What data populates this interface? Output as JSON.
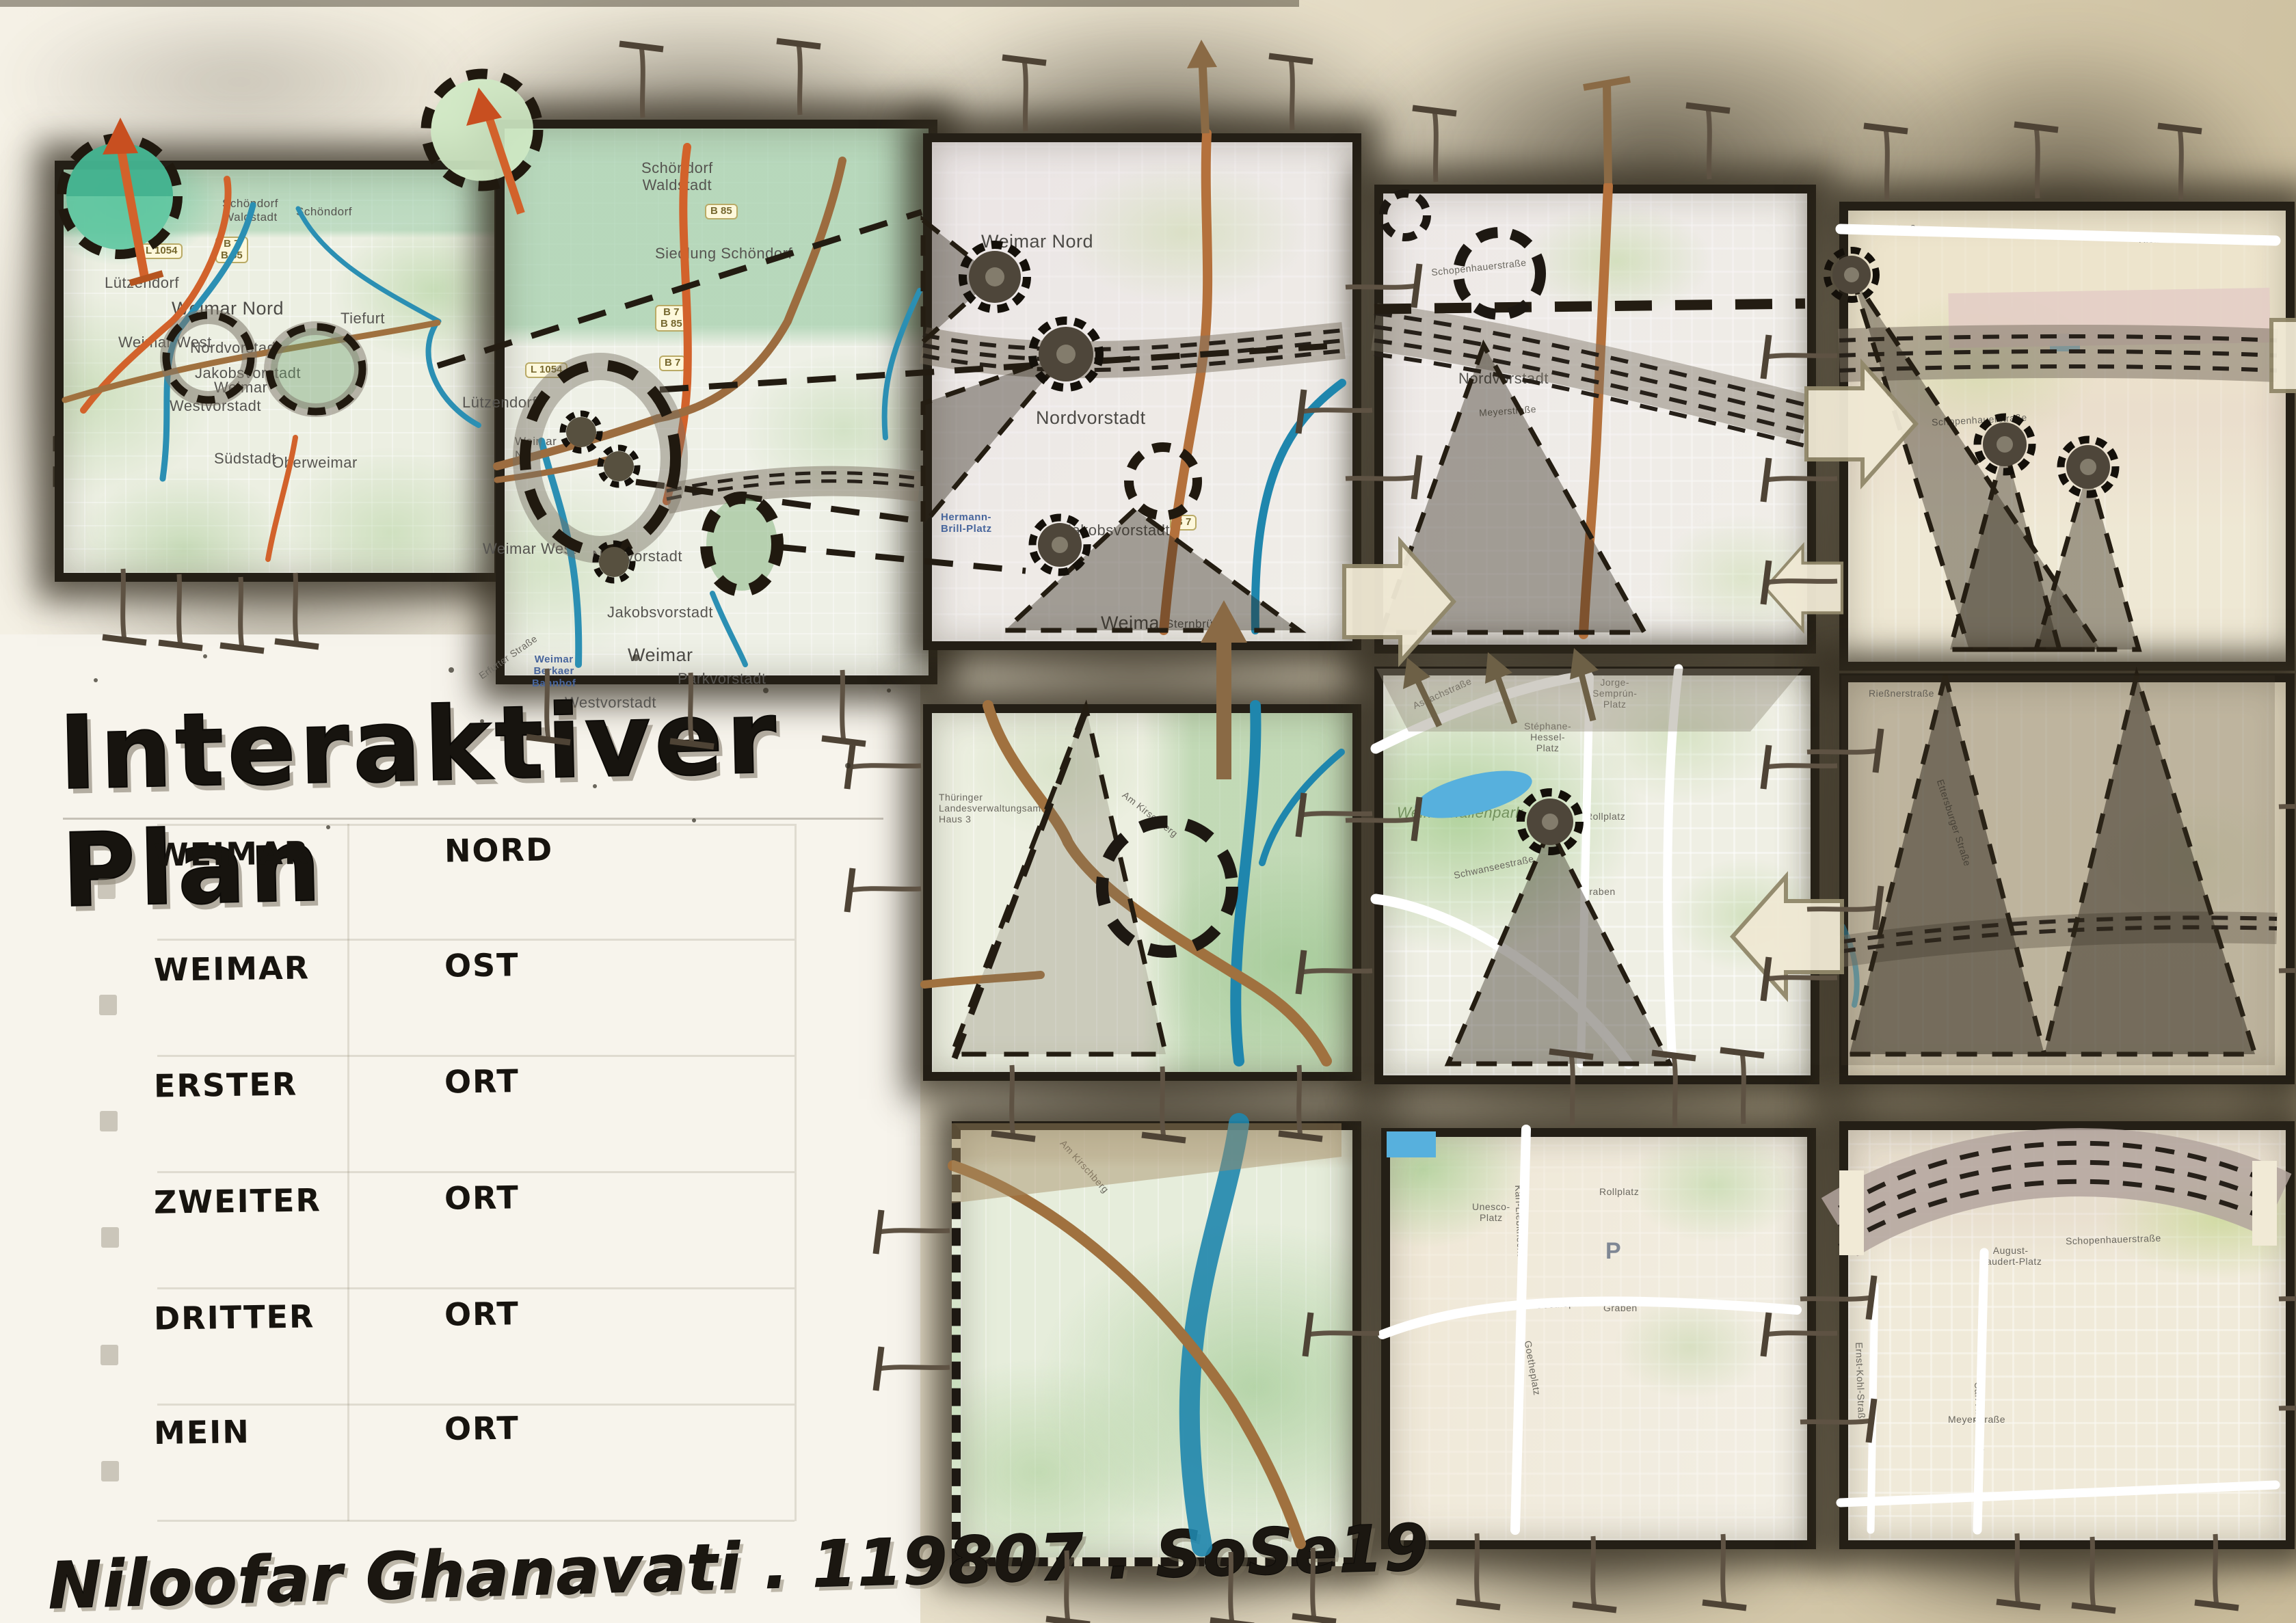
{
  "title": "Interaktiver Plan",
  "signature": "Niloofar Ghanavati . 119807 . SoSe19",
  "legend": {
    "rows": [
      {
        "w1": "WEIMAR",
        "w2": "NORD"
      },
      {
        "w1": "WEIMAR",
        "w2": "OST"
      },
      {
        "w1": "ERSTER",
        "w2": "ORT"
      },
      {
        "w1": "ZWEITER",
        "w2": "ORT"
      },
      {
        "w1": "DRITTER",
        "w2": "ORT"
      },
      {
        "w1": "MEIN",
        "w2": "ORT"
      }
    ]
  },
  "panels": {
    "p1": {
      "labels": [
        "Schöndorf\nWaldstadt",
        "Schöndorf",
        "Lützendorf",
        "Weimar Nord",
        "Tiefurt",
        "Weimar West",
        "Nordvorstadt",
        "Jakobsvorstadt",
        "Weimar",
        "Westvorstadt",
        "Südstadt",
        "Oberweimar"
      ],
      "badges": [
        "L 1054",
        "B 7\nB 85"
      ]
    },
    "p2": {
      "labels": [
        "Schöndorf\nWaldstadt",
        "Siedlung Schöndorf",
        "Lützendorf",
        "Weimar\nNord",
        "Weimar West",
        "Nordvorstadt",
        "Jakobsvorstadt",
        "Weimar",
        "Parkvorstadt",
        "Westvorstadt",
        "Weimar\nBerkaer\nBahnhof",
        "Erfurter Straße"
      ],
      "badges": [
        "B 85",
        "B 7\nB 85",
        "B 7",
        "L 1054"
      ]
    },
    "p3a": {
      "labels": [
        "Weimar Nord",
        "Nordvorstadt",
        "Jakobsvorstadt",
        "Weimar",
        "Sternbrücke",
        "Hermann-\nBrill-Platz"
      ],
      "badges": [
        "B 7"
      ]
    },
    "p3b": {
      "labels": [
        "Thüringer\nLandesverwaltungsamt\nHaus 3",
        "Am Kirschberg"
      ]
    },
    "p3c": {
      "labels": [
        "Am Kirschberg"
      ]
    },
    "p4a": {
      "labels": [
        "Nordvorstadt",
        "Schopenhauerstraße",
        "Meyerstraße"
      ]
    },
    "p4b": {
      "labels": [
        "Weimarhallenpark",
        "Asbachstraße",
        "Schwanseestraße",
        "Stéphane-\nHessel-\nPlatz",
        "Jorge-\nSemprún-\nPlatz",
        "Rollplatz",
        "Graben"
      ]
    },
    "p4c": {
      "labels": [
        "Unesco-\nPlatz",
        "Goetheplatz",
        "Goetheplatz",
        "Graben",
        "Rollplatz",
        "Karl-Liebknecht-Straße",
        "P"
      ]
    },
    "p5a": {
      "labels": [
        "Rießnerstraße",
        "Rießnerstraße",
        "Rießnerstraße",
        "Schopenhauerstraße"
      ]
    },
    "p5b": {
      "labels": [
        "Rießnerstraße",
        "Ettersburger Straße"
      ]
    },
    "p5c": {
      "labels": [
        "August-\nBaudert-Platz",
        "Schopenhauerstraße",
        "Carl-August-Allee",
        "Ernst-Kohl-Straße",
        "Meyerstraße"
      ]
    }
  }
}
